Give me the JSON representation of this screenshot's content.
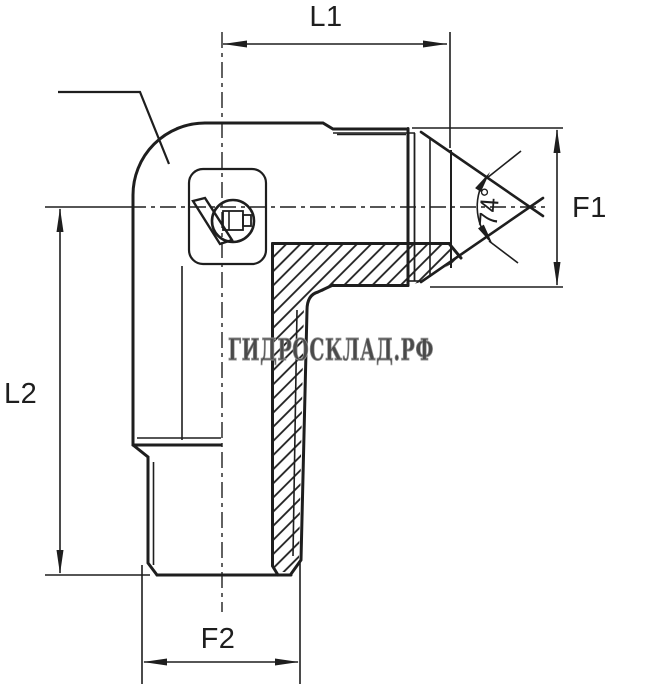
{
  "drawing": {
    "type": "technical-drawing",
    "subject": "90-degree elbow hydraulic adapter, half-section view",
    "labels": {
      "l1": "L1",
      "l2": "L2",
      "f1": "F1",
      "f2": "F2",
      "angle": "74°"
    },
    "watermark": "ГИДРОСКЛАД.РФ",
    "colors": {
      "line": "#1e1e1e",
      "background": "#ffffff",
      "watermark_fill": "#4a4a4a",
      "watermark_outline": "#8f8f8f"
    }
  }
}
